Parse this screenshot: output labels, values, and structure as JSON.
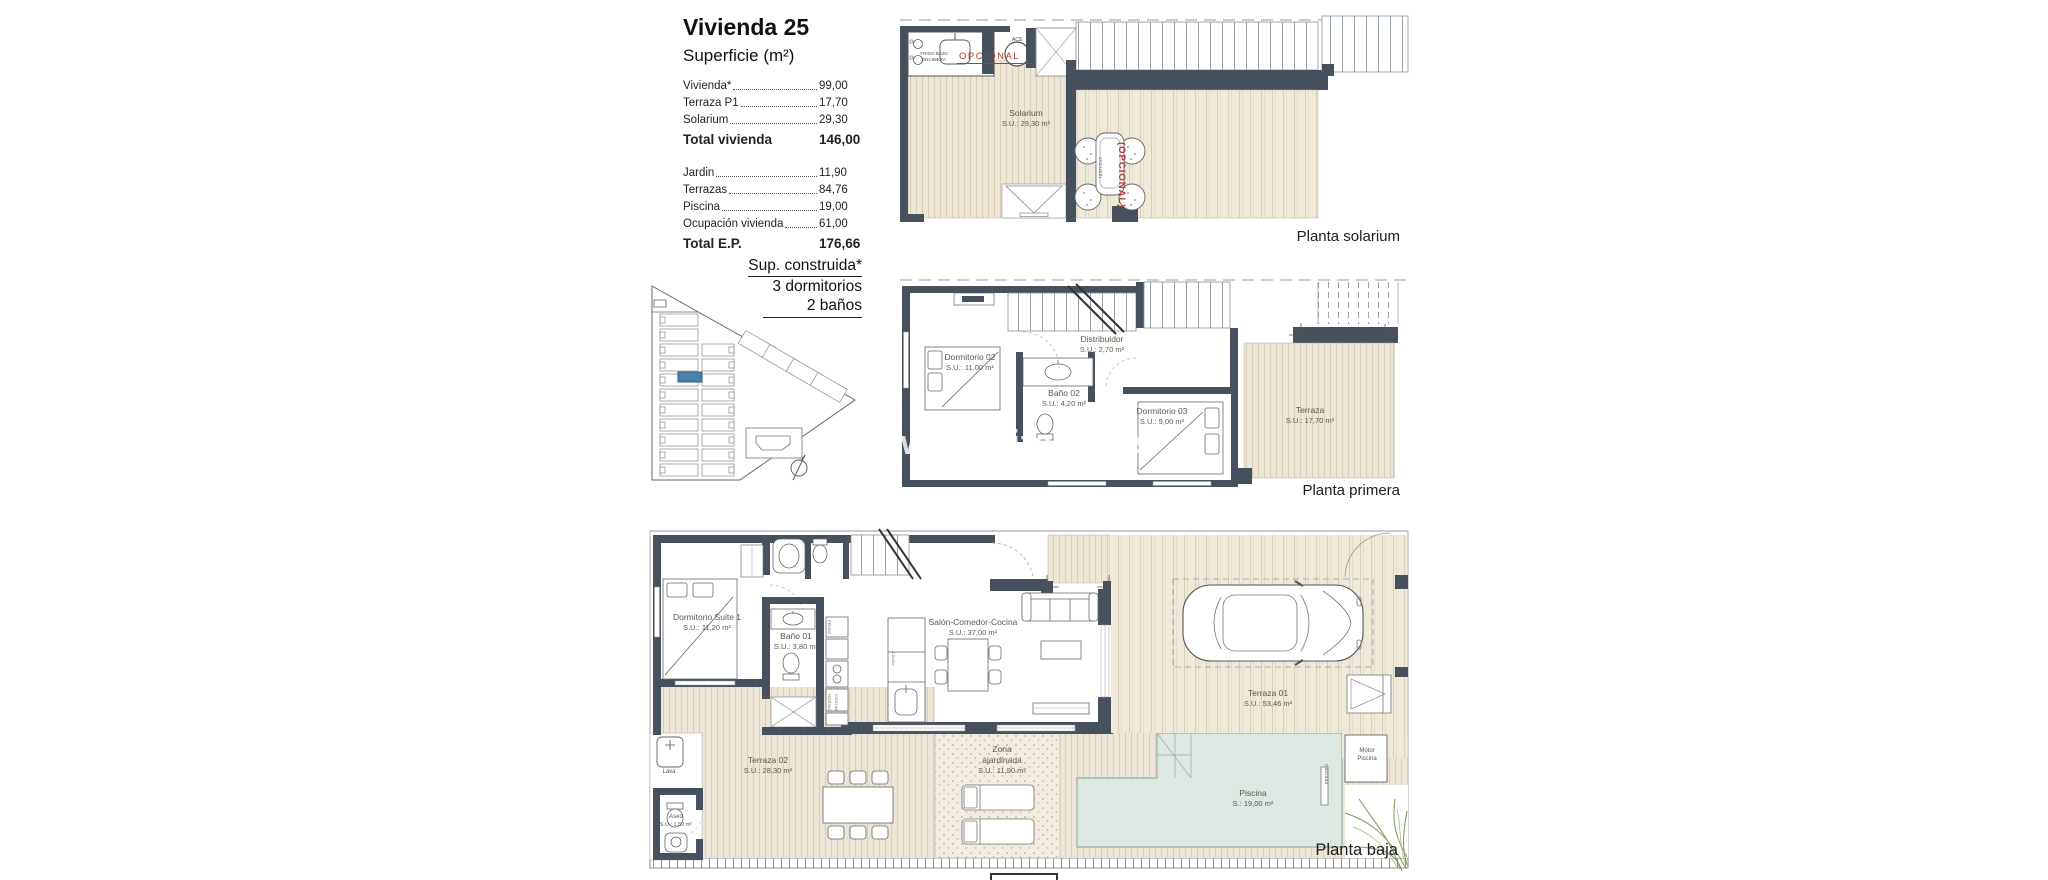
{
  "info": {
    "title": "Vivienda 25",
    "subtitle": "Superficie (m²)",
    "rows1": [
      {
        "label": "Vivienda*",
        "value": "99,00"
      },
      {
        "label": "Terraza P1",
        "value": "17,70"
      },
      {
        "label": "Solarium",
        "value": "29,30"
      }
    ],
    "total1_label": "Total vivienda",
    "total1_value": "146,00",
    "rows2": [
      {
        "label": "Jardin",
        "value": "11,90"
      },
      {
        "label": "Terrazas",
        "value": "84,76"
      },
      {
        "label": "Piscina",
        "value": "19,00"
      },
      {
        "label": "Ocupación vivienda",
        "value": "61,00"
      }
    ],
    "total2_label": "Total E.P.",
    "total2_value": "176,66"
  },
  "summary": {
    "line1": "Sup. construida*",
    "line2": "3 dormitorios",
    "line3": "2 baños"
  },
  "watermark": "www.mediterrane",
  "plans": {
    "solarium": {
      "title": "Planta solarium",
      "rooms": {
        "solarium": {
          "name": "Solarium",
          "area": "S.U.: 29,30 m²"
        }
      },
      "notes": {
        "opcional": "OPCIONAL",
        "frigo": "FRIGO BAJO ENCIMERA",
        "acs": "ACS",
        "jacuzzi": "JACUZZI",
        "jacuzzi_opt": "(OPCIONAL)"
      }
    },
    "primera": {
      "title": "Planta primera",
      "rooms": {
        "dorm02": {
          "name": "Dormitorio 02",
          "area": "S.U.: 11,00 m²"
        },
        "distribuidor": {
          "name": "Distribuidor",
          "area": "S.U.: 2,70 m²"
        },
        "bano02": {
          "name": "Baño 02",
          "area": "S.U.: 4,20 m²"
        },
        "dorm03": {
          "name": "Dormitorio 03",
          "area": "S.U.: 9,00 m²"
        },
        "terraza": {
          "name": "Terraza",
          "area": "S.U.: 17,70 m²"
        }
      }
    },
    "baja": {
      "title": "Planta baja",
      "rooms": {
        "suite": {
          "name": "Dormitorio Suite 1",
          "area": "S.U.: 11,20 m²"
        },
        "bano01": {
          "name": "Baño 01",
          "area": "S.U.: 3,80 m²"
        },
        "salon": {
          "name": "Salón-Comedor-Cocina",
          "area": "S.U.: 37,00 m²"
        },
        "terraza01": {
          "name": "Terraza 01",
          "area": "S.U.: 53,46 m²"
        },
        "terraza02": {
          "name": "Terraza 02",
          "area": "S.U.: 28,30 m²"
        },
        "zona": {
          "name": "Zona ajardinada",
          "area": "S.U.: 11,90 m²"
        },
        "piscina": {
          "name": "Piscina",
          "area": "S.: 19,00 m²"
        },
        "aseo": {
          "name": "Aseo",
          "area": "S.U.: 1,50 m²"
        }
      },
      "notes": {
        "lava": "Lava",
        "motor1": "Motor",
        "motor2": "Piscina",
        "cascada": "Cascada",
        "frigo": "FRIGO",
        "horno": "HORNO",
        "cocina": "COCINA",
        "lavav": "LAVAV."
      }
    }
  },
  "colors": {
    "wall": "#47515e",
    "deck": "#ede6d6",
    "deck_line": "#d8cdb6",
    "pool": "#dde8e3",
    "accent_red": "#b23b34",
    "highlight_blue": "#4a80aa"
  }
}
